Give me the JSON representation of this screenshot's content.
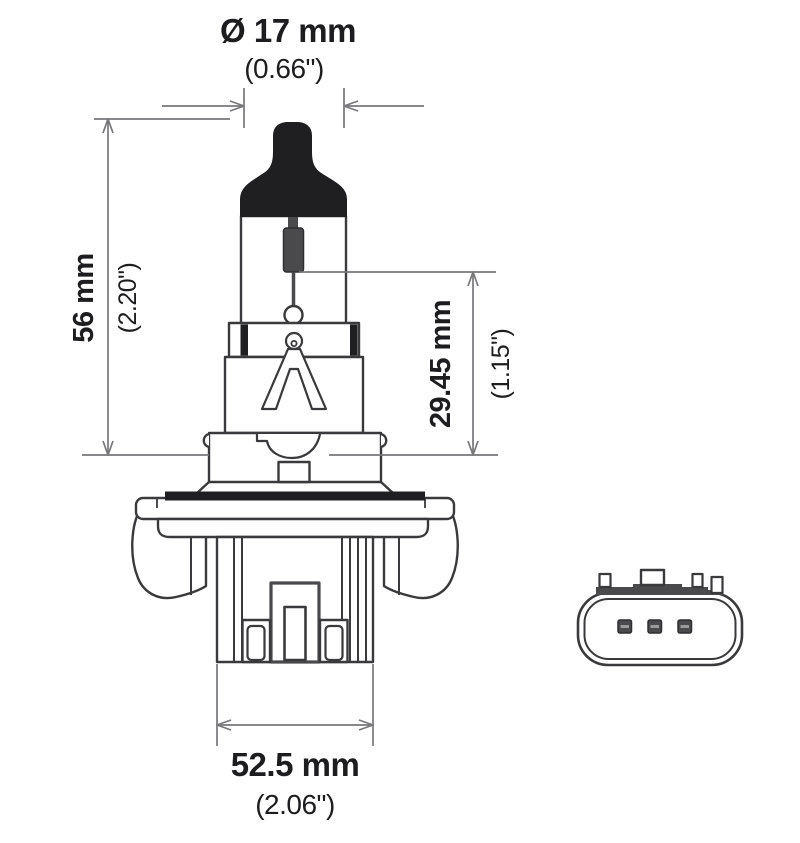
{
  "figure": {
    "kind": "halogen-bulb-technical-drawing",
    "background_color": "#ffffff",
    "outline_color": "#3a3a3c",
    "dimension_line_color": "#77777a",
    "black_fill_color": "#1f1f21",
    "gray_fill_color": "#4a4a4c",
    "text_color": "#1d1d1f"
  },
  "dimensions": {
    "diameter": {
      "mm": "Ø 17 mm",
      "inch": "(0.66\")"
    },
    "overall_length": {
      "mm": "56 mm",
      "inch": "(2.20\")"
    },
    "filament_to_flange": {
      "mm": "29.45 mm",
      "inch": "(1.15\")"
    },
    "base_width": {
      "mm": "52.5 mm",
      "inch": "(2.06\")"
    }
  }
}
